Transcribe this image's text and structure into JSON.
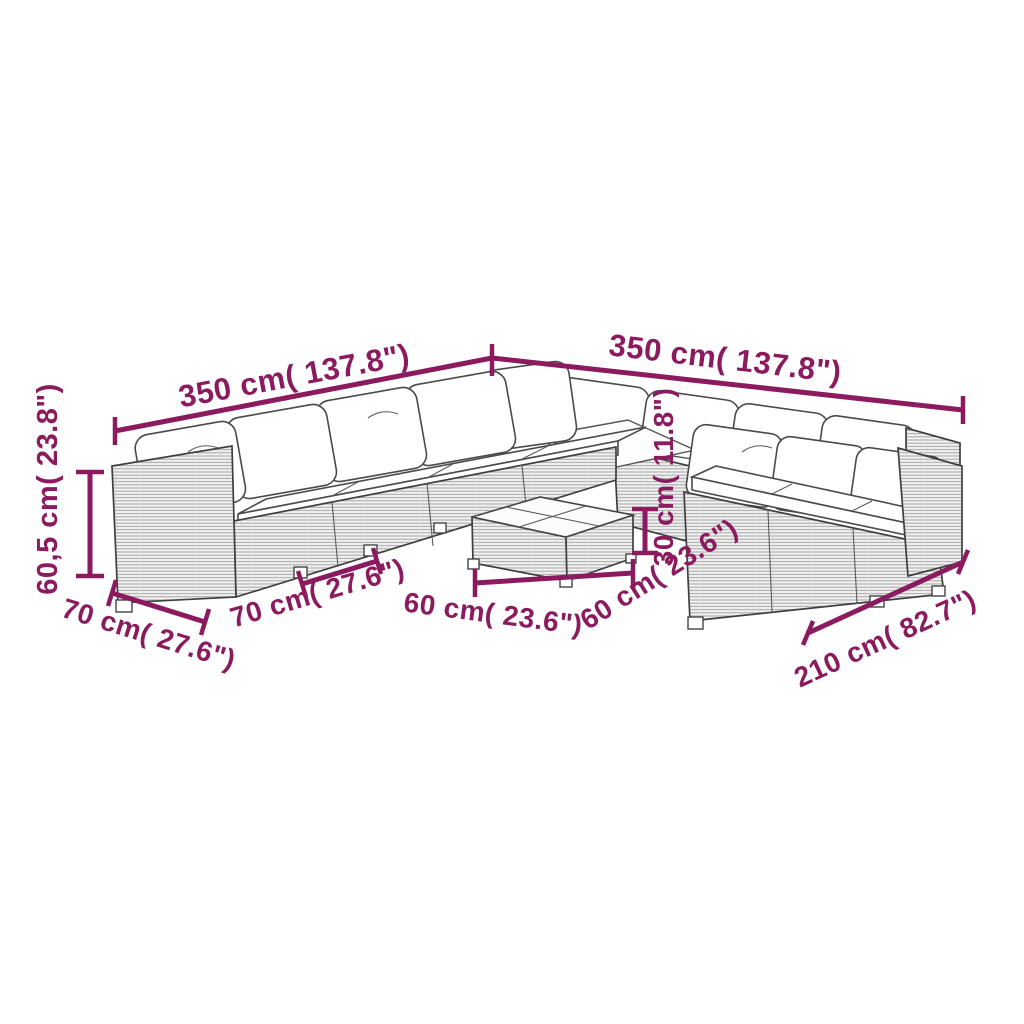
{
  "diagram": {
    "type": "product-dimension-diagram",
    "colors": {
      "dimension_accent": "#8B1A5F",
      "line_art": "#454545",
      "background": "#FFFFFF"
    },
    "dimensions": {
      "back_left_width": {
        "label": "350 cm( 137.8\")"
      },
      "back_right_width": {
        "label": "350 cm( 137.8\")"
      },
      "seat_height": {
        "label": "60,5 cm( 23.8\")"
      },
      "arm_module_depth": {
        "label": "70 cm( 27.6\")"
      },
      "seat_module_width": {
        "label": "70 cm( 27.6\")"
      },
      "table_width": {
        "label": "60 cm( 23.6\")"
      },
      "table_depth": {
        "label": "60 cm( 23.6\")"
      },
      "table_height": {
        "label": "30 cm( 11.8\")"
      },
      "right_sofa_width": {
        "label": "210 cm( 82.7\")"
      }
    }
  }
}
